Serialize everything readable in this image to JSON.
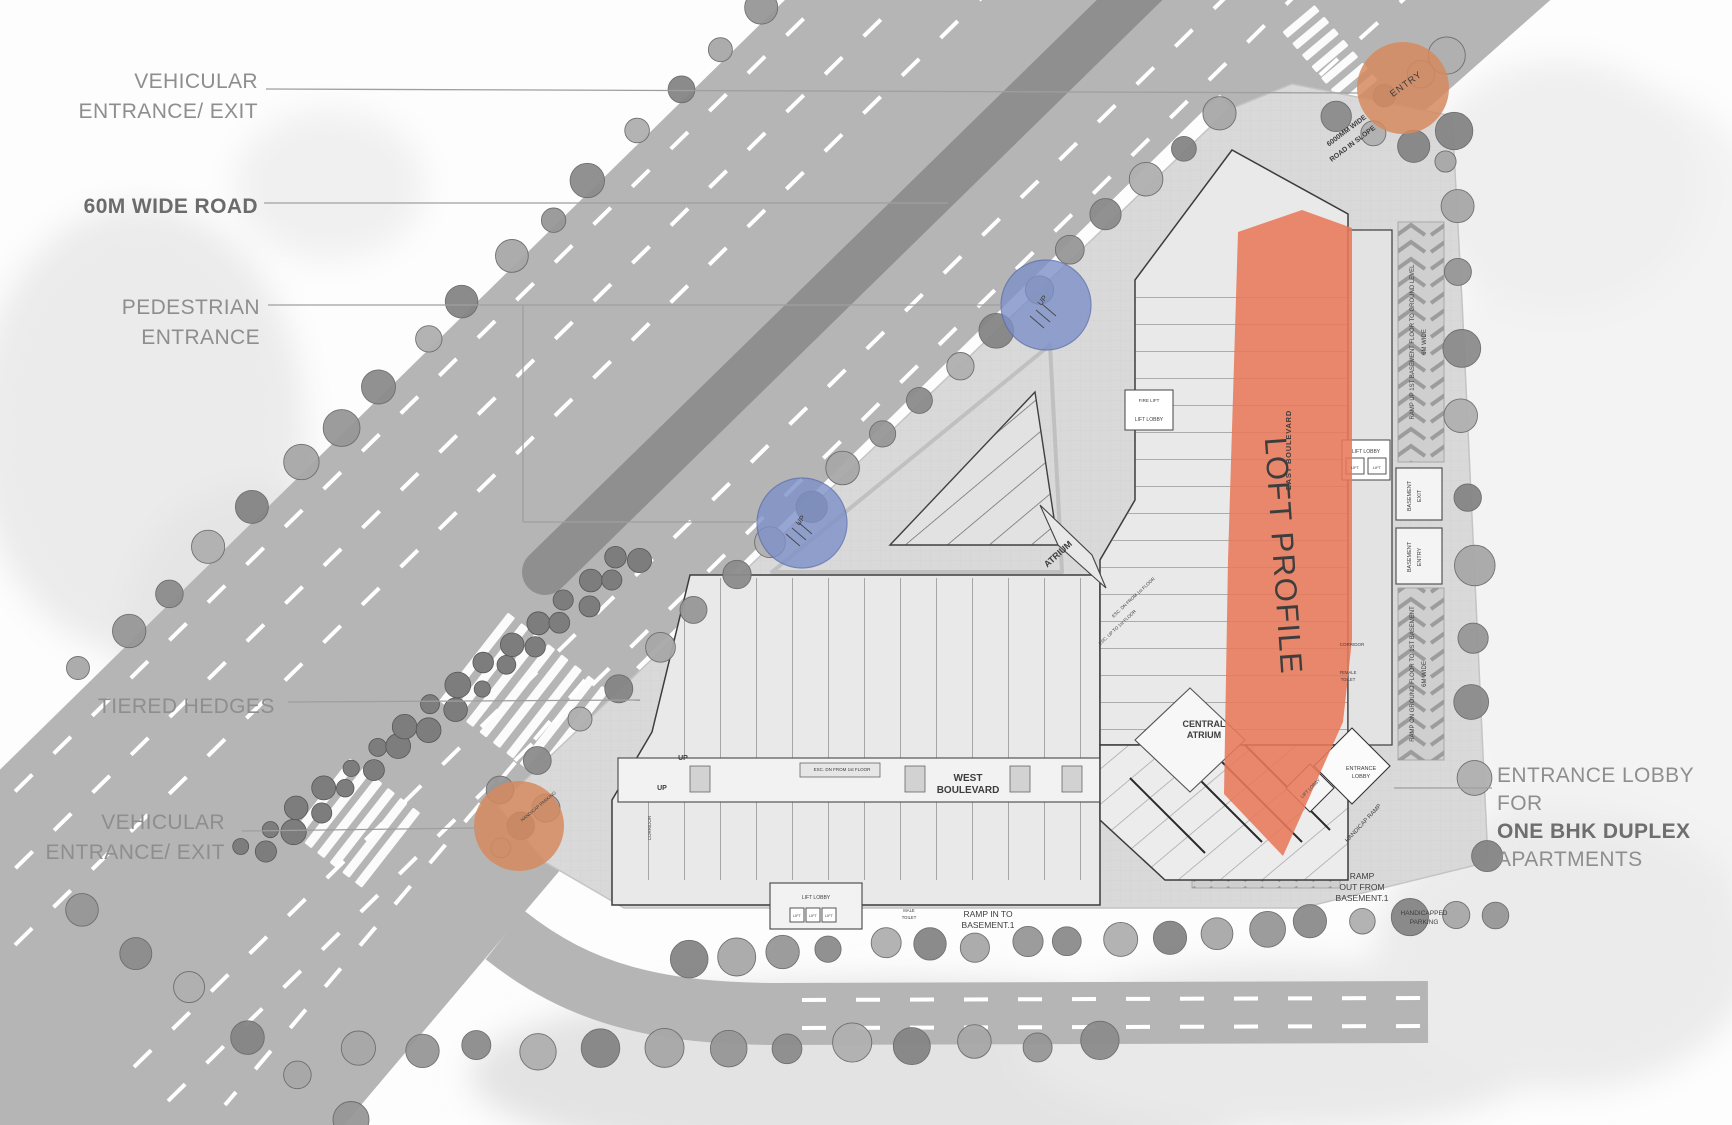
{
  "callouts": {
    "vehicular_top": {
      "l1": "VEHICULAR",
      "l2": "ENTRANCE/ EXIT"
    },
    "wide_road": "60M WIDE ROAD",
    "pedestrian": "PEDESTRIAN ENTRANCE",
    "hedges": "TIERED HEDGES",
    "vehicular_bottom": {
      "l1": "VEHICULAR",
      "l2": "ENTRANCE/ EXIT"
    },
    "lobby": {
      "l1": "ENTRANCE LOBBY FOR",
      "l2": "ONE BHK DUPLEX",
      "l3": "APARTMENTS"
    }
  },
  "plan": {
    "labels": {
      "entry": "ENTRY",
      "loft_profile": "LOFT PROFILE",
      "east_boulevard": "EAST BOULEVARD",
      "west_boulevard": {
        "l1": "WEST",
        "l2": "BOULEVARD"
      },
      "central_atrium": {
        "l1": "CENTRAL",
        "l2": "ATRIUM"
      },
      "atrium": "ATRIUM",
      "lift_lobby": "LIFT LOBBY",
      "lift": "LIFT",
      "fire_lift": "FIRE LIFT",
      "corridor": "CORRIDOR",
      "male_toilet": {
        "l1": "MALE",
        "l2": "TOILET"
      },
      "female_toilet": {
        "l1": "FEMALE",
        "l2": "TOILET"
      },
      "entrance_lobby": {
        "l1": "ENTRANCE",
        "l2": "LOBBY"
      },
      "basement_exit": {
        "l1": "BASEMENT",
        "l2": "EXIT"
      },
      "basement_entry": {
        "l1": "BASEMENT",
        "l2": "ENTRY"
      },
      "ramp_up_east": {
        "l1": "RAMP UP 1ST BASEMENT FLOOR TO GROUND LEVEL",
        "l2": "6M WIDE"
      },
      "ramp_down_east": {
        "l1": "RAMP ON GROUND FLOOR TO 1ST BASEMENT",
        "l2": "6M WIDE"
      },
      "ramp_in": {
        "l1": "RAMP IN TO",
        "l2": "BASEMENT.1"
      },
      "ramp_out": {
        "l1": "RAMP",
        "l2": "OUT FROM",
        "l3": "BASEMENT.1"
      },
      "handicapped_parking": {
        "l1": "HANDICAPPED",
        "l2": "PARKING"
      },
      "handicap_ramp": "HANDICAP RAMP",
      "road_slope": {
        "l1": "6000MM WIDE",
        "l2": "ROAD IN SLOPE"
      },
      "esc_dn": "ESC. DN FROM 1st FLOOR",
      "esc_up": "ESC. UP TO 1st FLOOR",
      "up": "UP",
      "handicap_parking_note": "HANDICAP PARKING"
    }
  },
  "colors": {
    "loft_band": "#E8795A",
    "entry_circle": "#D68A5F",
    "pedestrian_circle": "#7D90C7",
    "road": "#B5B5B5",
    "median": "#8F8F8F",
    "label_gray": "#8E8E8E"
  }
}
